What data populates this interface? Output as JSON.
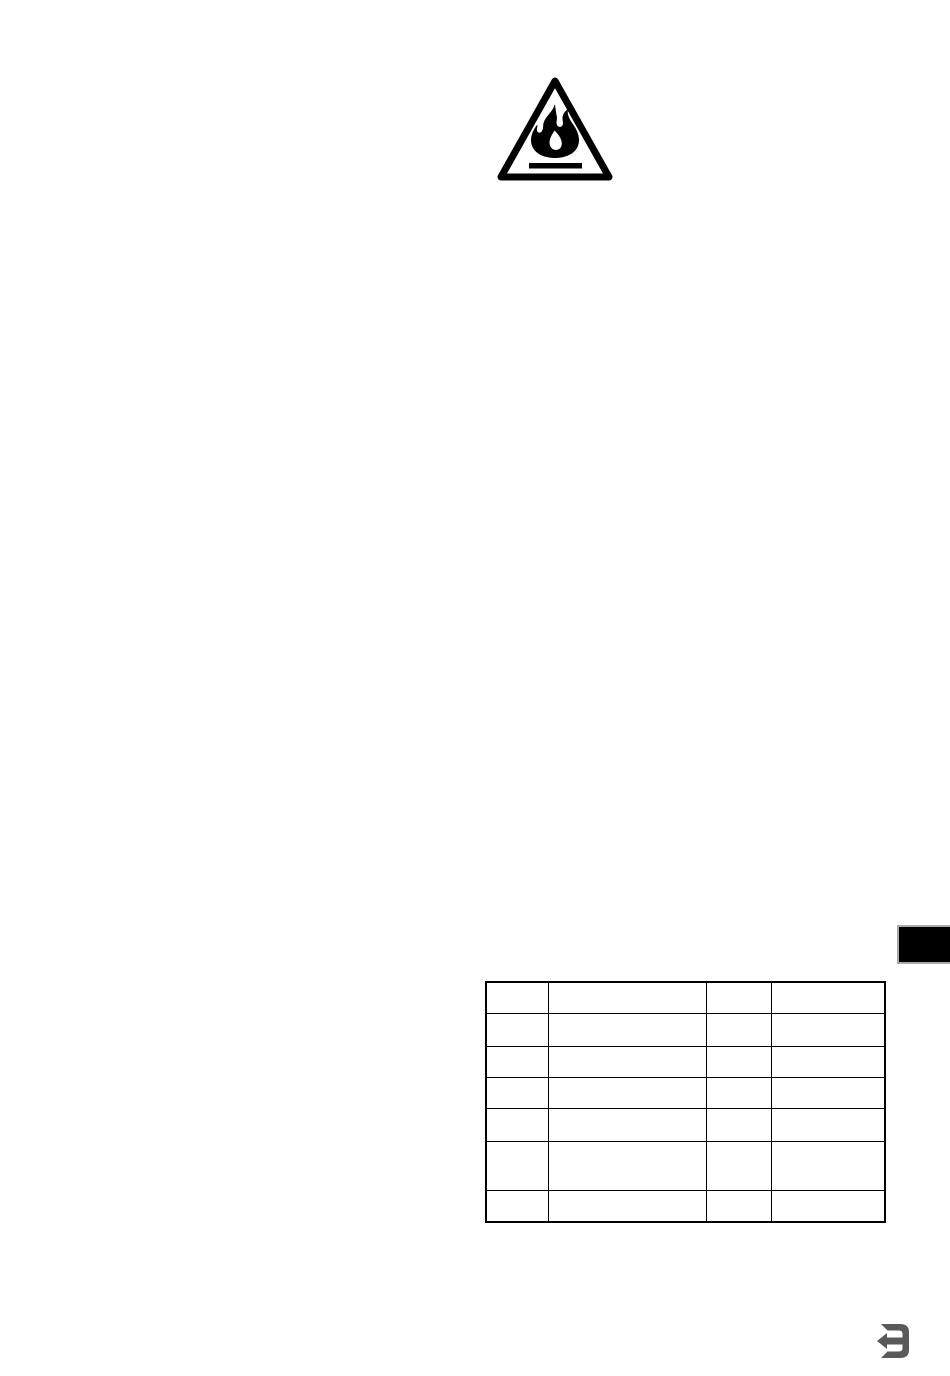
{
  "page": {
    "background_color": "#ffffff",
    "page_number": "3"
  },
  "warning": {
    "icon": "flammable-warning-triangle-icon",
    "ink_color": "#000000"
  },
  "chapter_tab": {
    "fill_color": "#000000",
    "border_color": "#a9a9a9"
  },
  "table": {
    "border_color": "#000000",
    "rows": [
      [
        "",
        "",
        "",
        ""
      ],
      [
        "",
        "",
        "",
        ""
      ],
      [
        "",
        "",
        "",
        ""
      ],
      [
        "",
        "",
        "",
        ""
      ],
      [
        "",
        "",
        "",
        ""
      ],
      [
        "",
        "",
        "",
        ""
      ],
      [
        "",
        "",
        "",
        ""
      ]
    ]
  },
  "footer": {
    "page_number": "3",
    "icon": "page-number-3-back-arrow-icon",
    "glyph_color": "#59595b"
  }
}
